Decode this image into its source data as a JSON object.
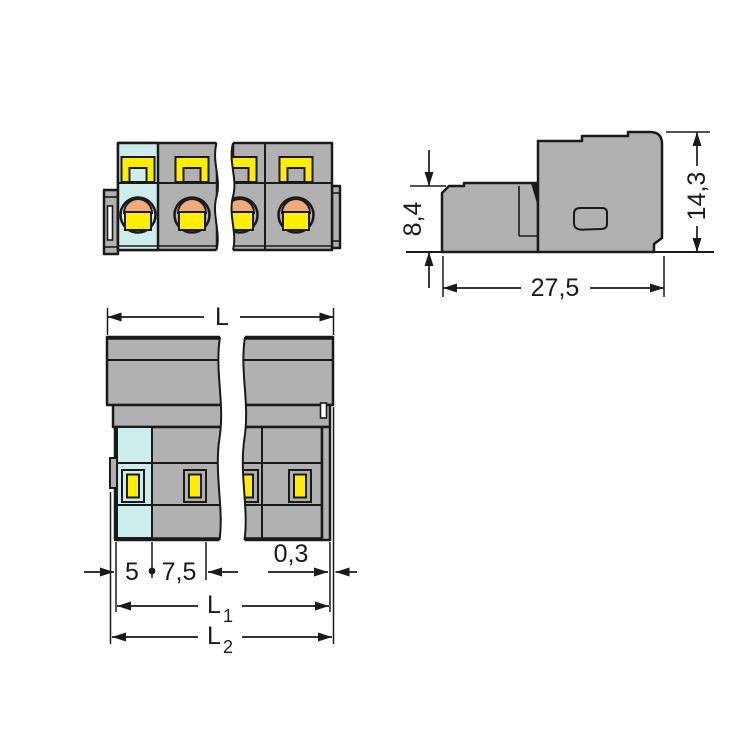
{
  "colors": {
    "background": "#ffffff",
    "body_gray": "#b1b1b1",
    "first_pole_cyan": "#cdecec",
    "actuator_yellow": "#ffee00",
    "clamp_orange": "#f2aa7b",
    "outline_black": "#1a1a1a",
    "white": "#ffffff"
  },
  "labels": {
    "dim_front_height": "8,4",
    "dim_total_height": "14,3",
    "dim_depth": "27,5",
    "dim_length": "L",
    "dim_edge_to_pole": "5",
    "dim_pole_pitch": "7,5",
    "dim_edge_offset": "0,3",
    "dim_l1_base": "L",
    "dim_l1_sub": "1",
    "dim_l2_base": "L",
    "dim_l2_sub": "2"
  }
}
